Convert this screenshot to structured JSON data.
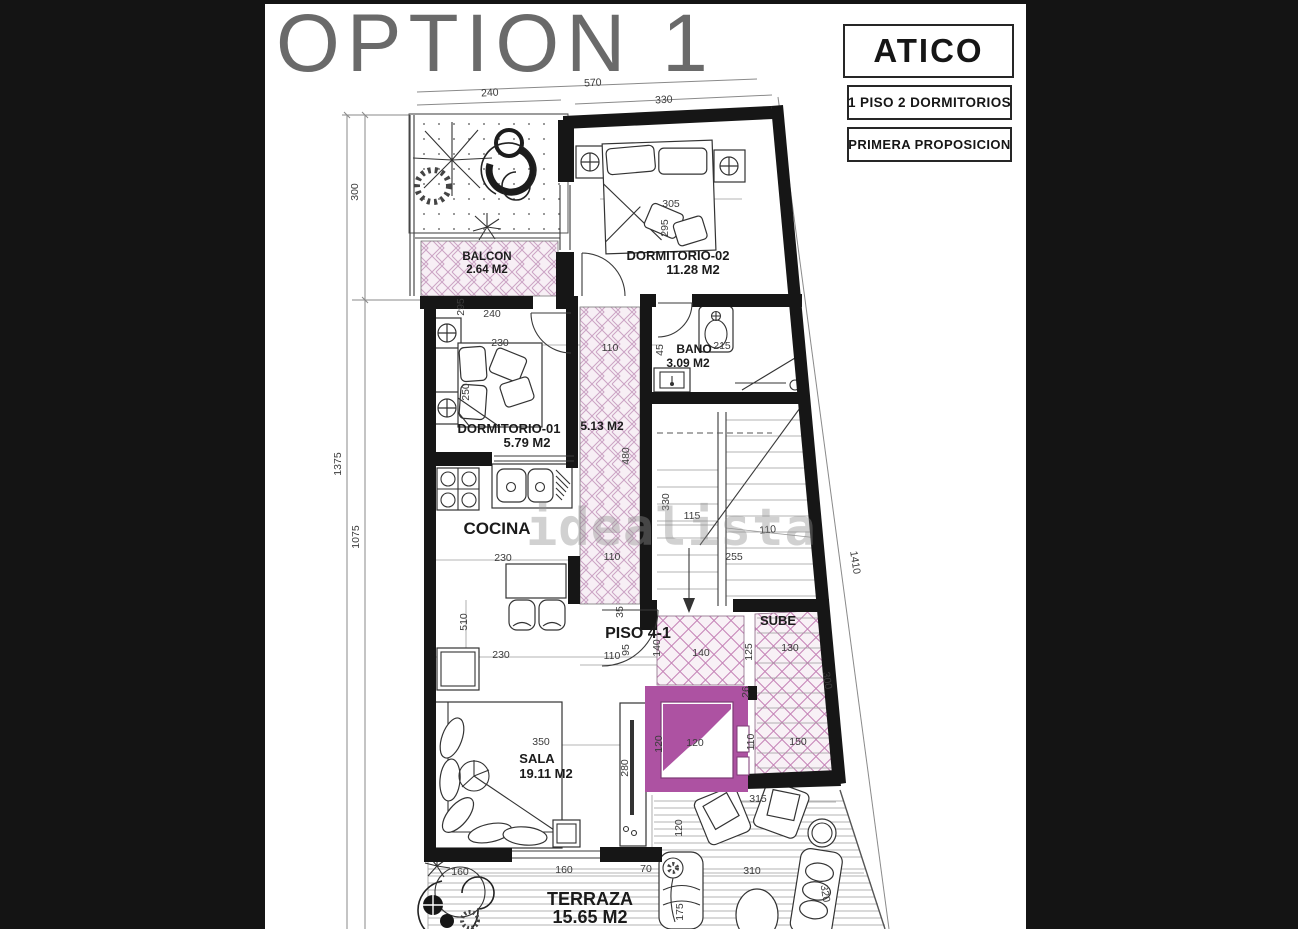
{
  "header": {
    "title": "OPTION 1",
    "badge_title": "ATICO",
    "badge_line1": "1 PISO 2 DORMITORIOS",
    "badge_line2": "PRIMERA PROPOSICION"
  },
  "watermark": {
    "text": "idealista"
  },
  "colors": {
    "background": "#141414",
    "paper": "#ffffff",
    "wall": "#161616",
    "elevator_purple": "#ad52a2",
    "hatch_line": "#c98fbd",
    "hatch_fill": "#f7eff5",
    "dimension_text": "#3b3b3b",
    "title_gray": "#6a6a6a"
  },
  "plan": {
    "rooms": [
      {
        "name": "BALCON",
        "area": "2.64 M2",
        "x": 487,
        "y": 260,
        "area_x": 487,
        "area_y": 273,
        "size": 11.5
      },
      {
        "name": "DORMITORIO-02",
        "area": "11.28 M2",
        "x": 678,
        "y": 260,
        "area_x": 693,
        "area_y": 274,
        "size": 13
      },
      {
        "name": "DORMITORIO-01",
        "area": "5.79 M2",
        "x": 509,
        "y": 433,
        "area_x": 527,
        "area_y": 447,
        "size": 13
      },
      {
        "name": "BANO",
        "area": "3.09 M2",
        "x": 694,
        "y": 353,
        "area_x": 688,
        "area_y": 367,
        "size": 12
      },
      {
        "name": "COCINA",
        "area": "",
        "x": 497,
        "y": 534,
        "area_x": 0,
        "area_y": 0,
        "size": 17
      },
      {
        "name": "5.13 M2",
        "area": "",
        "x": 602,
        "y": 430,
        "area_x": 0,
        "area_y": 0,
        "size": 12
      },
      {
        "name": "PISO 4-1",
        "area": "",
        "x": 638,
        "y": 638,
        "area_x": 0,
        "area_y": 0,
        "size": 16
      },
      {
        "name": "SUBE",
        "area": "",
        "x": 778,
        "y": 625,
        "area_x": 0,
        "area_y": 0,
        "size": 13
      },
      {
        "name": "SALA",
        "area": "19.11 M2",
        "x": 537,
        "y": 763,
        "area_x": 546,
        "area_y": 778,
        "size": 13
      },
      {
        "name": "TERRAZA",
        "area": "15.65 M2",
        "x": 590,
        "y": 905,
        "area_x": 590,
        "area_y": 923,
        "size": 18
      }
    ],
    "dimensions": [
      {
        "t": "240",
        "x": 490,
        "y": 96,
        "r": -3
      },
      {
        "t": "570",
        "x": 593,
        "y": 86,
        "r": -3
      },
      {
        "t": "330",
        "x": 664,
        "y": 103,
        "r": -3
      },
      {
        "t": "300",
        "x": 358,
        "y": 192,
        "r": -90
      },
      {
        "t": "1375",
        "x": 341,
        "y": 464,
        "r": -90
      },
      {
        "t": "1075",
        "x": 359,
        "y": 537,
        "r": -90
      },
      {
        "t": "1410",
        "x": 852,
        "y": 563,
        "r": 81
      },
      {
        "t": "295",
        "x": 464,
        "y": 307,
        "r": -90
      },
      {
        "t": "240",
        "x": 492,
        "y": 317,
        "r": 0
      },
      {
        "t": "305",
        "x": 671,
        "y": 207,
        "r": 0
      },
      {
        "t": "295",
        "x": 668,
        "y": 228,
        "r": -90
      },
      {
        "t": "230",
        "x": 500,
        "y": 346,
        "r": 0
      },
      {
        "t": "250",
        "x": 469,
        "y": 392,
        "r": -90
      },
      {
        "t": "110",
        "x": 610,
        "y": 351,
        "r": 0
      },
      {
        "t": "480",
        "x": 629,
        "y": 456,
        "r": -90
      },
      {
        "t": "45",
        "x": 663,
        "y": 350,
        "r": -90
      },
      {
        "t": "215",
        "x": 722,
        "y": 349,
        "r": 0
      },
      {
        "t": "330",
        "x": 669,
        "y": 502,
        "r": -90
      },
      {
        "t": "115",
        "x": 692,
        "y": 519,
        "r": 0
      },
      {
        "t": "110",
        "x": 768,
        "y": 533,
        "r": -5
      },
      {
        "t": "255",
        "x": 734,
        "y": 560,
        "r": 0
      },
      {
        "t": "230",
        "x": 503,
        "y": 561,
        "r": 0
      },
      {
        "t": "110",
        "x": 612,
        "y": 560,
        "r": 0
      },
      {
        "t": "35",
        "x": 623,
        "y": 612,
        "r": -90
      },
      {
        "t": "110",
        "x": 612,
        "y": 659,
        "r": 0
      },
      {
        "t": "95",
        "x": 629,
        "y": 650,
        "r": -90
      },
      {
        "t": "140",
        "x": 660,
        "y": 648,
        "r": -90
      },
      {
        "t": "140",
        "x": 701,
        "y": 656,
        "r": 0
      },
      {
        "t": "125",
        "x": 752,
        "y": 652,
        "r": -90
      },
      {
        "t": "26",
        "x": 749,
        "y": 692,
        "r": -90
      },
      {
        "t": "130",
        "x": 790,
        "y": 651,
        "r": 0
      },
      {
        "t": "300",
        "x": 824,
        "y": 681,
        "r": 81
      },
      {
        "t": "150",
        "x": 798,
        "y": 745,
        "r": 0
      },
      {
        "t": "110",
        "x": 754,
        "y": 742,
        "r": -90
      },
      {
        "t": "120",
        "x": 662,
        "y": 744,
        "r": -90
      },
      {
        "t": "120",
        "x": 695,
        "y": 746,
        "r": 0
      },
      {
        "t": "510",
        "x": 467,
        "y": 622,
        "r": -90
      },
      {
        "t": "230",
        "x": 501,
        "y": 658,
        "r": 0
      },
      {
        "t": "350",
        "x": 541,
        "y": 745,
        "r": 0
      },
      {
        "t": "280",
        "x": 628,
        "y": 768,
        "r": -90
      },
      {
        "t": "315",
        "x": 758,
        "y": 802,
        "r": 0
      },
      {
        "t": "120",
        "x": 682,
        "y": 828,
        "r": -90
      },
      {
        "t": "160",
        "x": 460,
        "y": 875,
        "r": 0
      },
      {
        "t": "160",
        "x": 564,
        "y": 873,
        "r": 0
      },
      {
        "t": "70",
        "x": 646,
        "y": 872,
        "r": 0
      },
      {
        "t": "310",
        "x": 752,
        "y": 874,
        "r": 0
      },
      {
        "t": "175",
        "x": 683,
        "y": 912,
        "r": -90
      },
      {
        "t": "320",
        "x": 822,
        "y": 894,
        "r": 81
      }
    ]
  }
}
